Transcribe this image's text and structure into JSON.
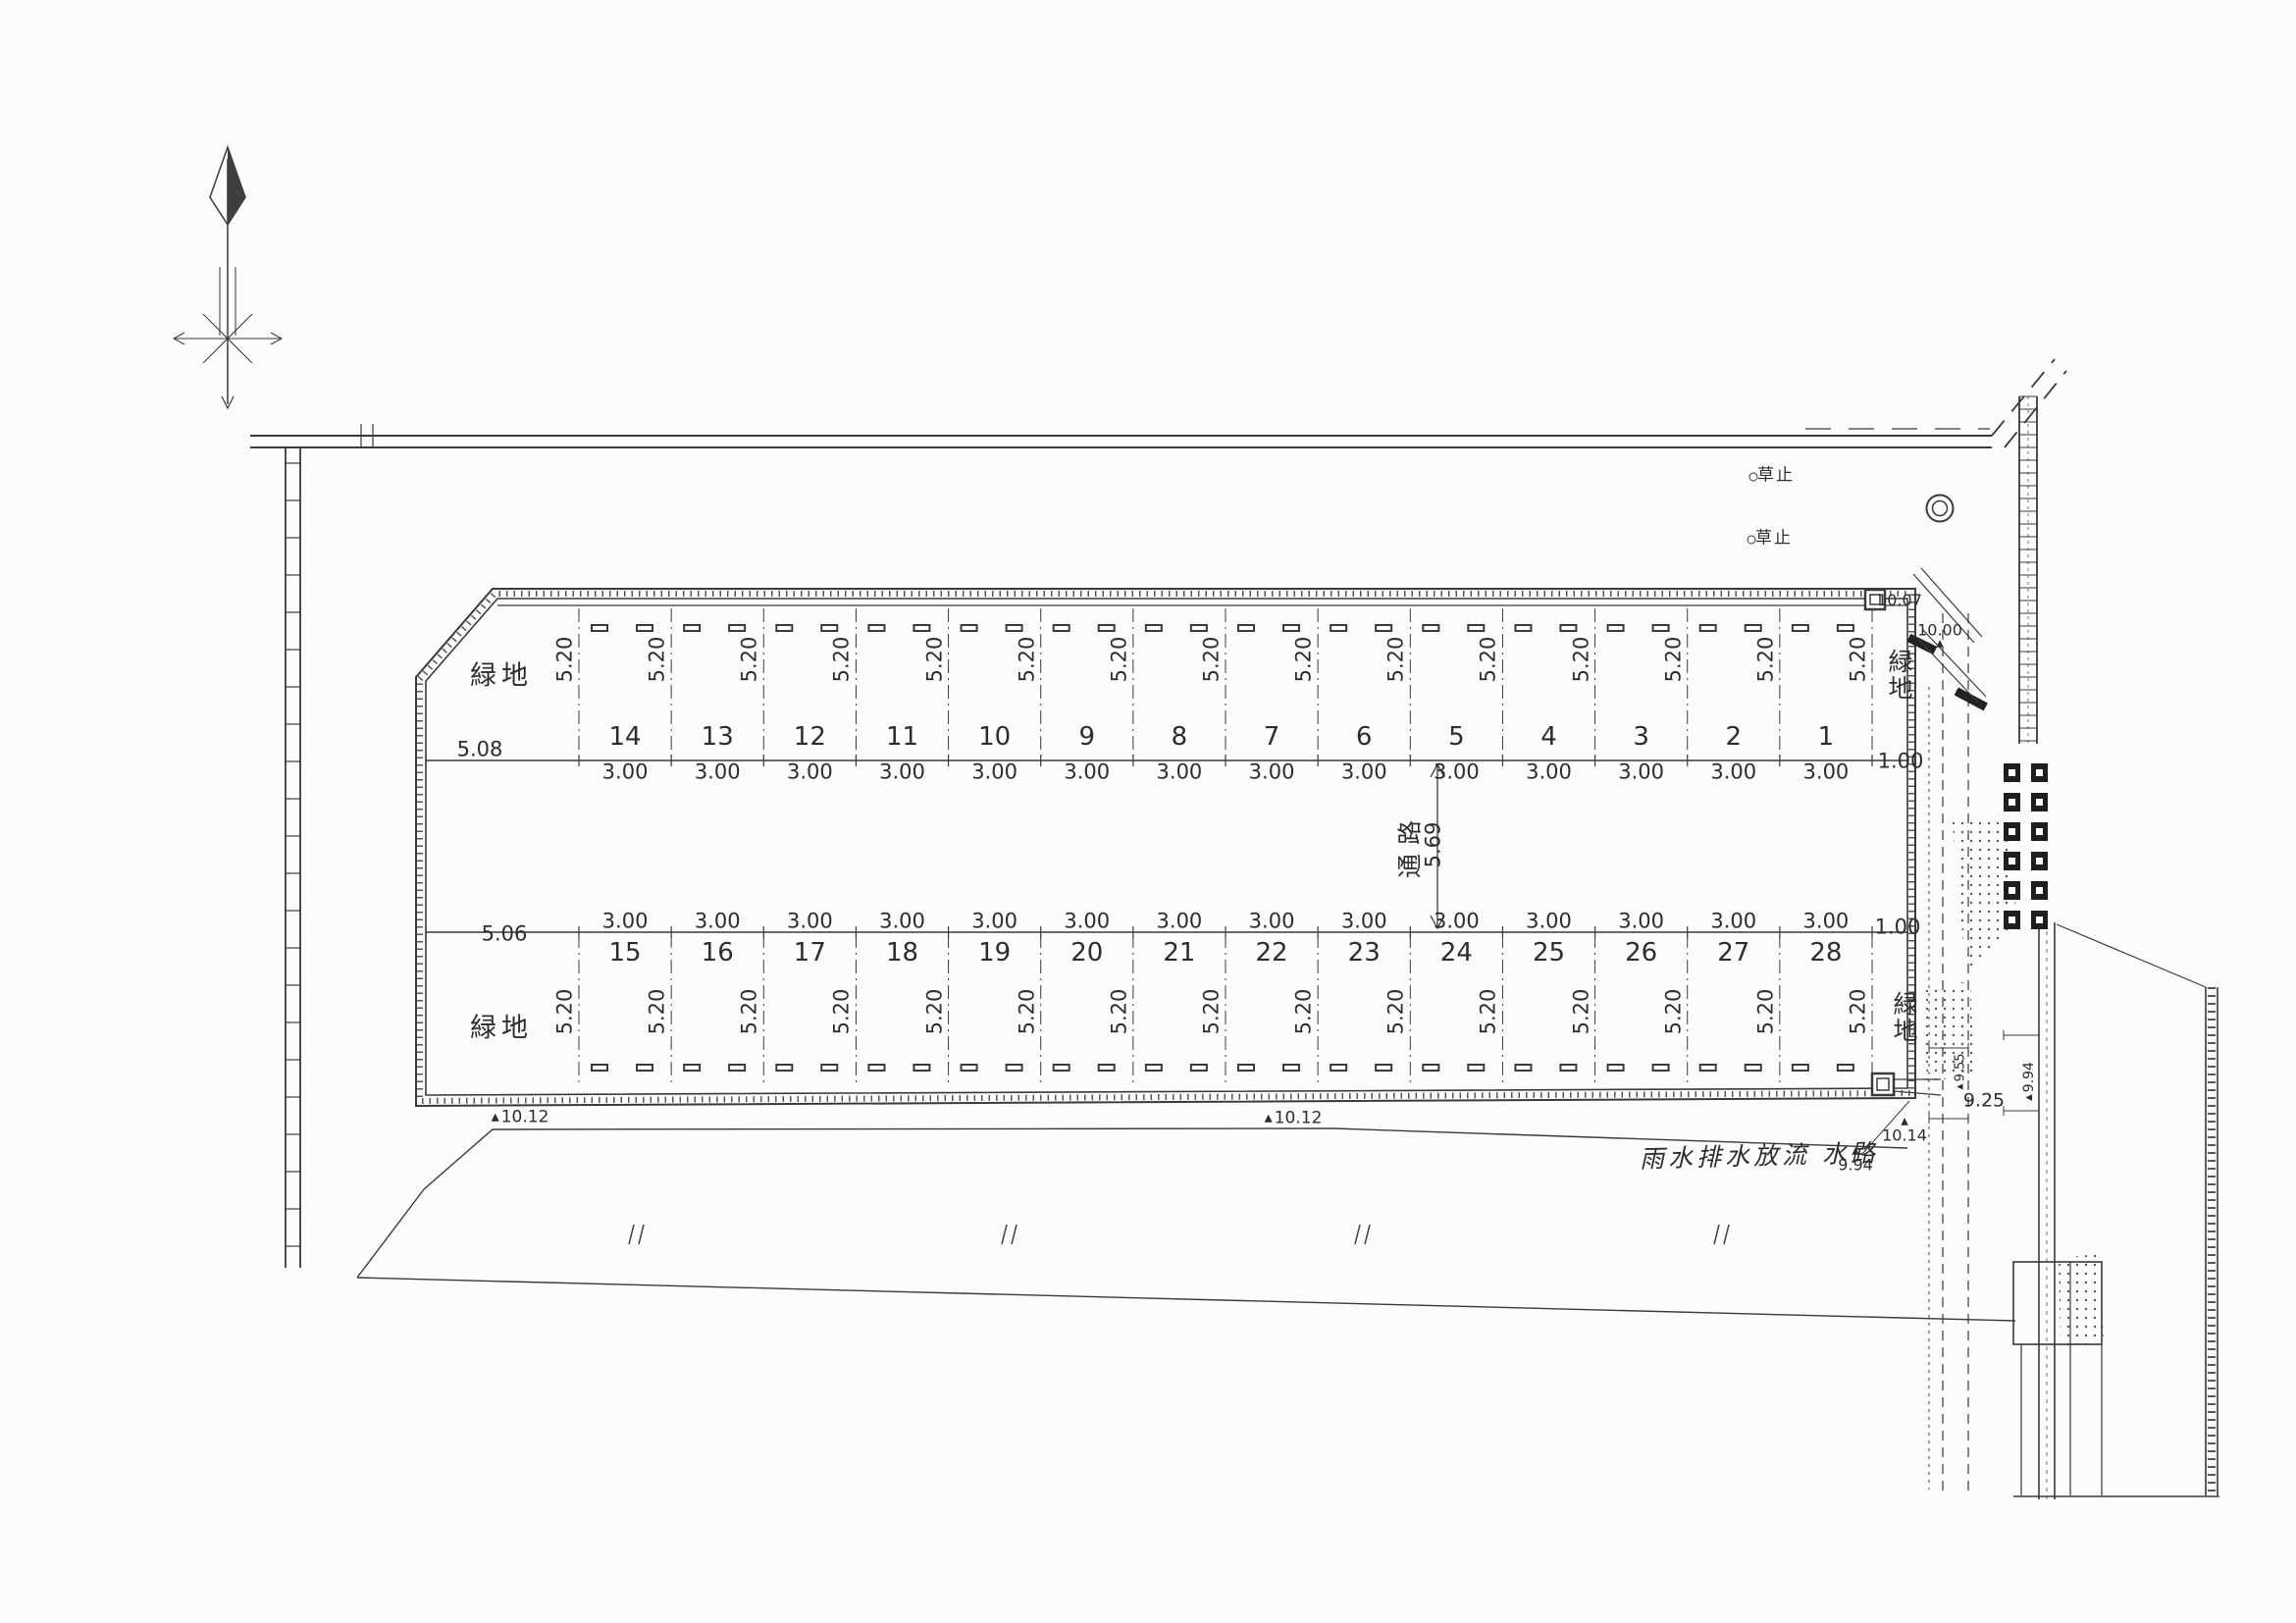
{
  "plan": {
    "icons": {
      "elevation_marker": "▲",
      "circle_marker": "○"
    },
    "site": {
      "green_label": "緑地",
      "aisle_label": "通路",
      "aisle_width": "5.69",
      "stall_width": "3.00",
      "stall_depth": "5.20",
      "green_left_top_width": "5.08",
      "green_left_bottom_width": "5.06",
      "green_right_width": "1.00",
      "top_row_numbers": [
        "14",
        "13",
        "12",
        "11",
        "10",
        "9",
        "8",
        "7",
        "6",
        "5",
        "4",
        "3",
        "2",
        "1"
      ],
      "bottom_row_numbers": [
        "15",
        "16",
        "17",
        "18",
        "19",
        "20",
        "21",
        "22",
        "23",
        "24",
        "25",
        "26",
        "27",
        "28"
      ]
    },
    "annotations": {
      "grass_stop_1": "草止",
      "grass_stop_2": "草止",
      "drainage_channel": "雨水排水放流 水路",
      "elev_top_right_corner": "10.07",
      "elev_slope": "10.00",
      "elev_bottom_left": "10.12",
      "elev_bottom_mid": "10.12",
      "elev_outlet_top": "10.14",
      "elev_outlet_bottom": "9.94",
      "elev_channel": "9.25",
      "elev_channel_side": "9.94",
      "elev_channel_small": "9.55"
    }
  }
}
